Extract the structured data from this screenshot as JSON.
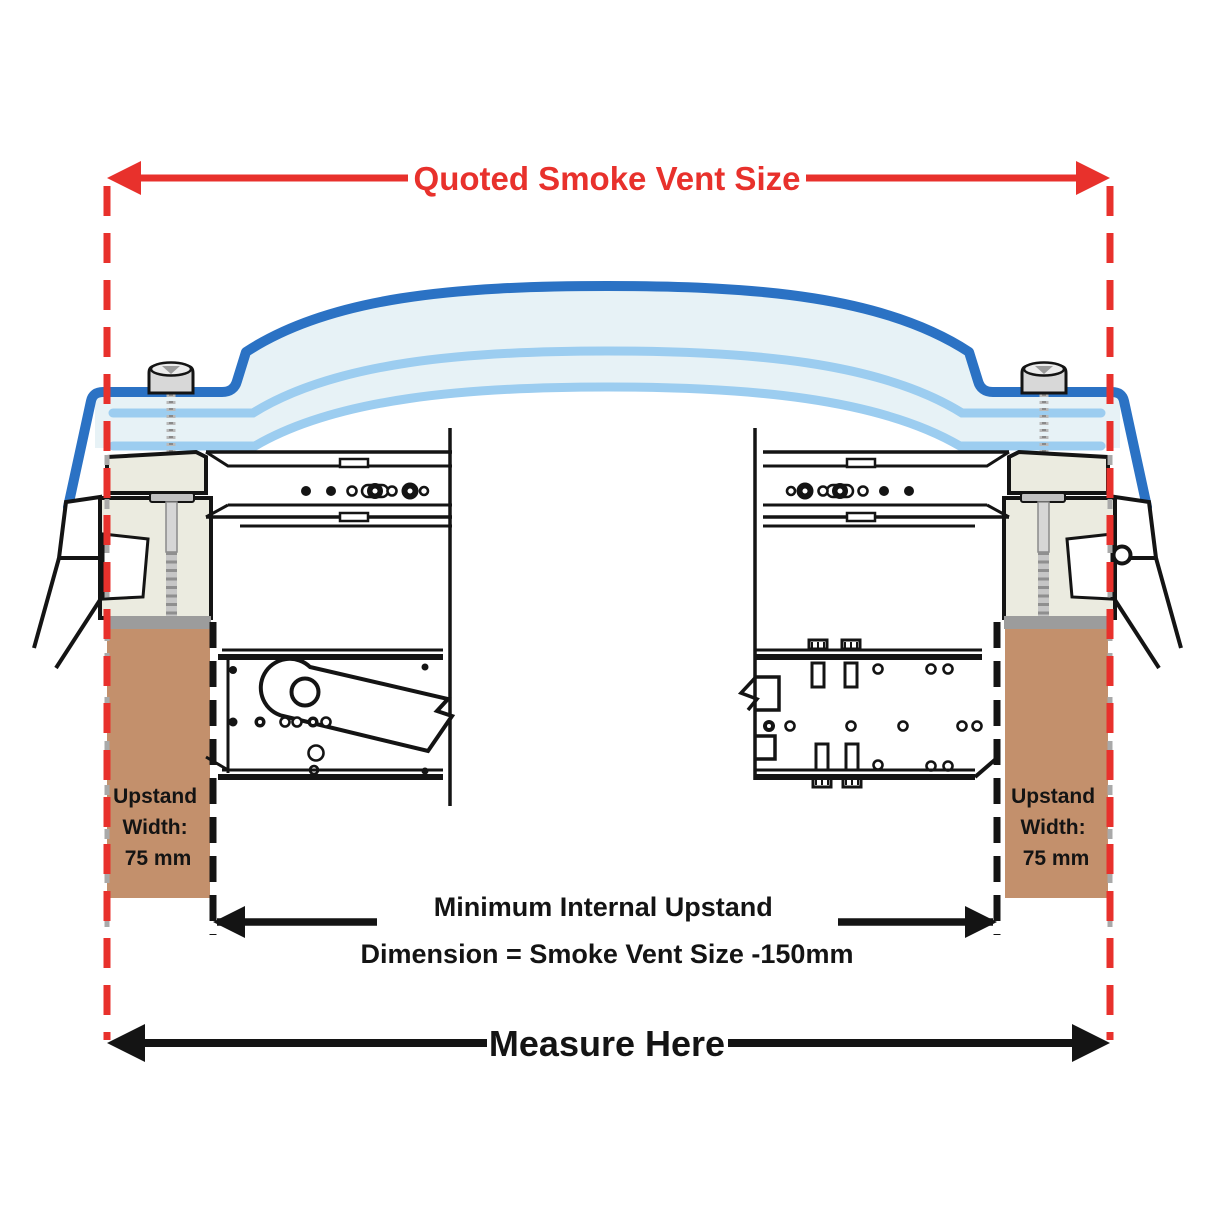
{
  "diagram": {
    "top_dimension": {
      "label": "Quoted Smoke Vent Size"
    },
    "internal_dimension": {
      "line1": "Minimum Internal Upstand",
      "line2": "Dimension = Smoke Vent Size -150mm"
    },
    "bottom_dimension": {
      "label": "Measure Here"
    },
    "left_upstand_label": {
      "line1": "Upstand",
      "line2": "Width:",
      "line3": "75 mm"
    },
    "right_upstand_label": {
      "line1": "Upstand",
      "line2": "Width:",
      "line3": "75 mm"
    }
  },
  "colors": {
    "dimension_red": "#e8312c",
    "dome_blue": "#2b72c4",
    "glazing_light_blue": "#9ccdf0",
    "glazing_pale_fill": "#e7f2f6",
    "frame_cream": "#ebebe0",
    "upstand_brown": "#c3906c",
    "line_black": "#141414",
    "screw_gray": "#c6c6c6",
    "gray_dash": "#a9a9a9"
  }
}
